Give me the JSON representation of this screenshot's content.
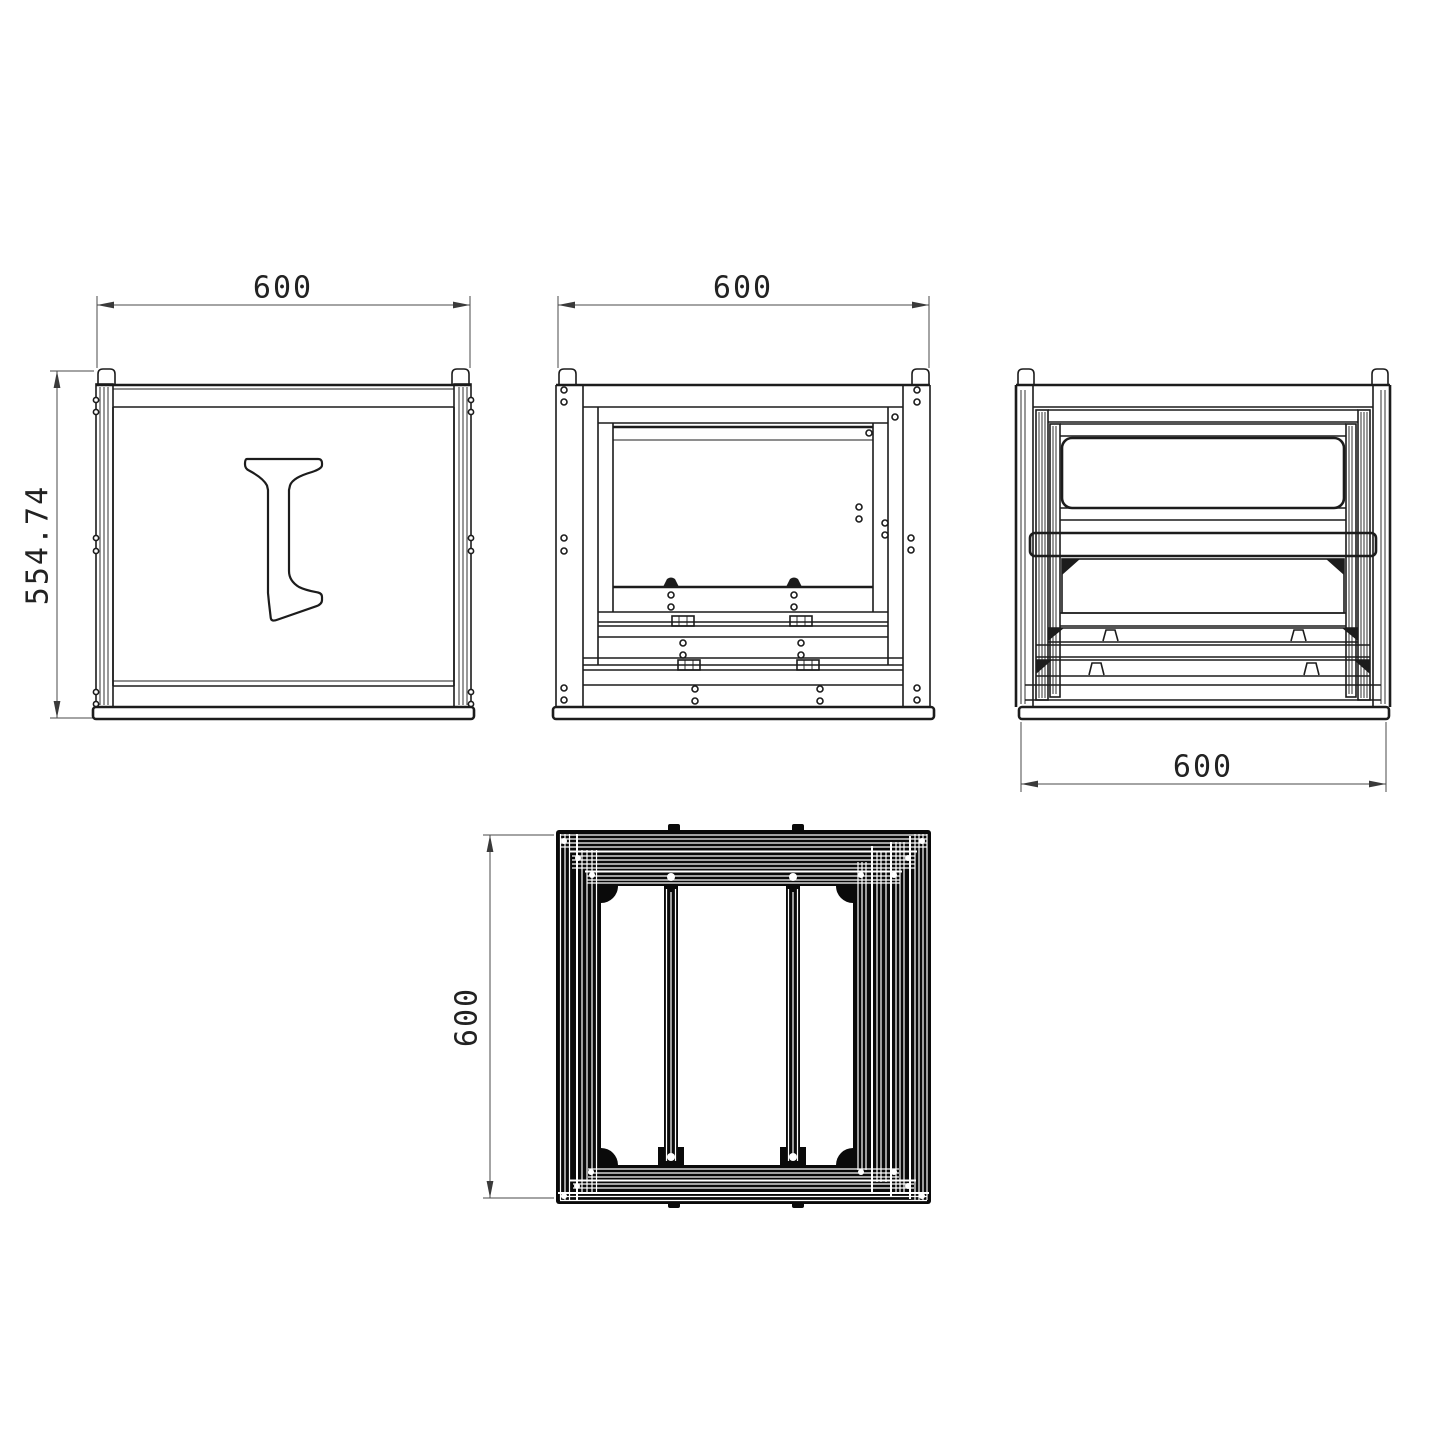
{
  "page": {
    "background": "#ffffff"
  },
  "palette": {
    "line": "#1c1c1c",
    "dark_fill": "#0a0a0a",
    "dim_line": "#4a4a4a"
  },
  "views": {
    "side": {
      "width_dim": "600",
      "height_dim": "554.74"
    },
    "front": {
      "width_dim": "600"
    },
    "back": {
      "width_dim": "600"
    },
    "top": {
      "depth_dim": "600"
    }
  }
}
